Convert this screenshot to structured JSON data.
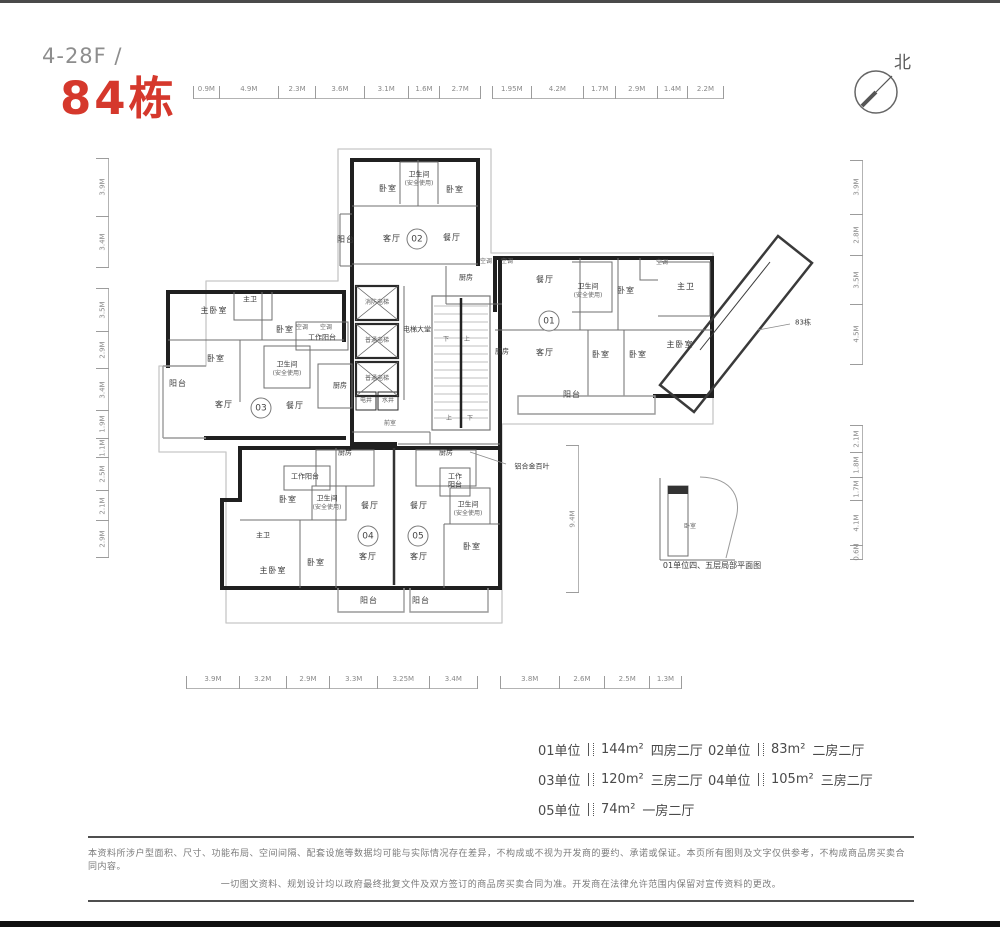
{
  "page": {
    "title_prefix": "4-28F /",
    "title_main": "84栋",
    "compass_north": "北"
  },
  "dimensions": {
    "top_left": [
      "0.9M",
      "4.9M",
      "2.3M",
      "3.6M",
      "3.1M",
      "1.6M",
      "2.7M"
    ],
    "top_right": [
      "1.95M",
      "4.2M",
      "1.7M",
      "2.9M",
      "1.4M",
      "2.2M"
    ],
    "bottom_left": [
      "3.9M",
      "3.2M",
      "2.9M",
      "3.3M",
      "3.25M",
      "3.4M"
    ],
    "bottom_right": [
      "3.8M",
      "2.6M",
      "2.5M",
      "1.3M"
    ],
    "left_upper": [
      "3.9M",
      "3.4M"
    ],
    "left_lower": [
      "3.5M",
      "2.9M",
      "3.4M",
      "1.9M",
      "1.1M",
      "2.5M",
      "2.1M",
      "2.9M"
    ],
    "right_upper": [
      "3.9M",
      "2.8M",
      "3.5M",
      "4.5M"
    ],
    "right_lower": [
      "2.1M",
      "1.8M",
      "1.7M",
      "4.1M",
      "0.6M"
    ],
    "middle_vertical": "9.4M"
  },
  "plan": {
    "units": {
      "u01": "01",
      "u02": "02",
      "u03": "03",
      "u04": "04",
      "u05": "05"
    },
    "labels": {
      "bedroom": "卧室",
      "master_bedroom": "主卧室",
      "master_bath": "主卫",
      "living": "客厅",
      "dining": "餐厅",
      "kitchen": "厨房",
      "bathroom": "卫生间",
      "bathroom_note": "(安全使用)",
      "balcony": "阳台",
      "work_balcony": "工作阳台",
      "ac": "空调",
      "elevator_lobby": "电梯大堂",
      "fire_elevator": "消防电梯",
      "passenger_elevator": "普通电梯",
      "elec_shaft": "电井",
      "water_shaft": "水井",
      "front_room": "前室",
      "up": "上",
      "down": "下",
      "louver": "铝合金百叶",
      "adjacent_building": "83栋",
      "inset_caption": "01单位四、五层局部平面图"
    }
  },
  "legend": {
    "items": [
      {
        "unit": "01单位",
        "area": "144m²",
        "type": "四房二厅"
      },
      {
        "unit": "02单位",
        "area": "83m²",
        "type": "二房二厅"
      },
      {
        "unit": "03单位",
        "area": "120m²",
        "type": "三房二厅"
      },
      {
        "unit": "04单位",
        "area": "105m²",
        "type": "三房二厅"
      },
      {
        "unit": "05单位",
        "area": "74m²",
        "type": "一房二厅"
      }
    ]
  },
  "disclaimer": {
    "line1": "本资料所涉户型面积、尺寸、功能布局、空间间隔、配套设施等数据均可能与实际情况存在差异，不构成或不视为开发商的要约、承诺或保证。本页所有图则及文字仅供参考，不构成商品房买卖合同内容。",
    "line2": "一切图文资料、规划设计均以政府最终批复文件及双方签订的商品房买卖合同为准。开发商在法律允许范围内保留对宣传资料的更改。"
  },
  "colors": {
    "accent_red": "#d5382c",
    "wall_dark": "#202020",
    "outline_gray": "#c6c6c6"
  }
}
